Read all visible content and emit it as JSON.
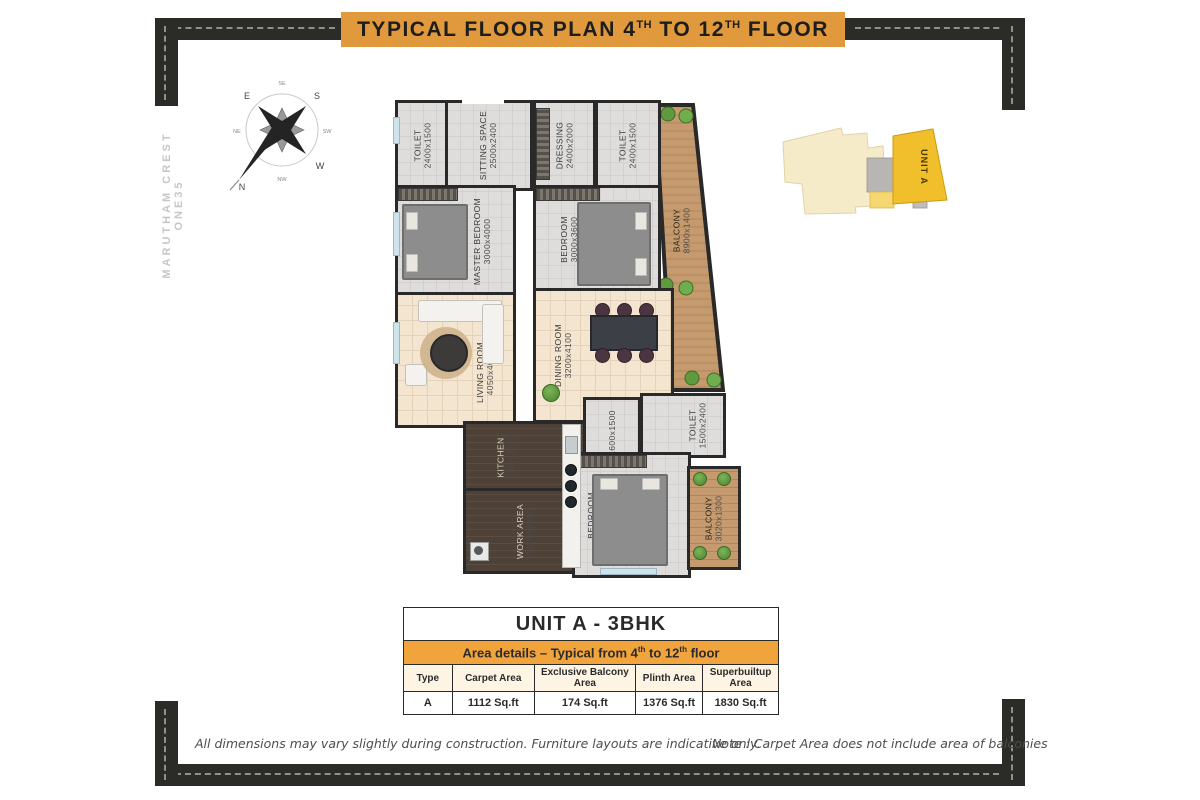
{
  "title": {
    "part1": "TYPICAL FLOOR PLAN 4",
    "sup1": "TH",
    "part2": " TO 12",
    "sup2": "TH",
    "part3": " FLOOR"
  },
  "watermark": "MARUTHAM CREST ONE35",
  "compass": {
    "n": "N",
    "ne": "NE",
    "e": "E",
    "se": "SE",
    "s": "S",
    "sw": "SW",
    "w": "W",
    "nw": "NW"
  },
  "floor_plan": {
    "rooms": [
      {
        "name": "TOILET",
        "dims": "2400x1500"
      },
      {
        "name": "SITTING SPACE",
        "dims": "2500x2400"
      },
      {
        "name": "DRESSING",
        "dims": "2400x2000"
      },
      {
        "name": "TOILET",
        "dims": "2400x1500"
      },
      {
        "name": "MASTER BEDROOM",
        "dims": "3000x4000"
      },
      {
        "name": "BEDROOM",
        "dims": "3000x3600"
      },
      {
        "name": "BALCONY",
        "dims": "8900x1400"
      },
      {
        "name": "LIVING ROOM",
        "dims": "4050x4000"
      },
      {
        "name": "DINING ROOM",
        "dims": "3200x4100"
      },
      {
        "name": "KITCHEN",
        "dims": "1900x3000"
      },
      {
        "name": "WORK AREA",
        "dims": "2200x2400"
      },
      {
        "name": "",
        "dims": "1600x1500"
      },
      {
        "name": "BEDROOM",
        "dims": "3350x3000"
      },
      {
        "name": "TOILET",
        "dims": "1500x2400"
      },
      {
        "name": "BALCONY",
        "dims": "3020x1300"
      }
    ]
  },
  "key_plan": {
    "unit_label": "UNIT A"
  },
  "unit_table": {
    "title": "UNIT A - 3BHK",
    "subtitle": {
      "part1": "Area details – Typical from 4",
      "sup1": "th",
      "part2": " to 12",
      "sup2": "th",
      "part3": " floor"
    },
    "columns": [
      "Type",
      "Carpet Area",
      "Exclusive Balcony Area",
      "Plinth Area",
      "Superbuiltup Area"
    ],
    "row": [
      "A",
      "1112 Sq.ft",
      "174 Sq.ft",
      "1376 Sq.ft",
      "1830 Sq.ft"
    ]
  },
  "footnotes": {
    "left": "All dimensions may vary slightly during construction. Furniture layouts are indicative only.",
    "right": "Note : Carpet Area does not include area of balconies"
  },
  "colors": {
    "accent_orange": "#e0993c",
    "table_orange": "#f2a43c",
    "frame_black": "#2b2b28",
    "unit_yellow": "#f1bf2b"
  }
}
